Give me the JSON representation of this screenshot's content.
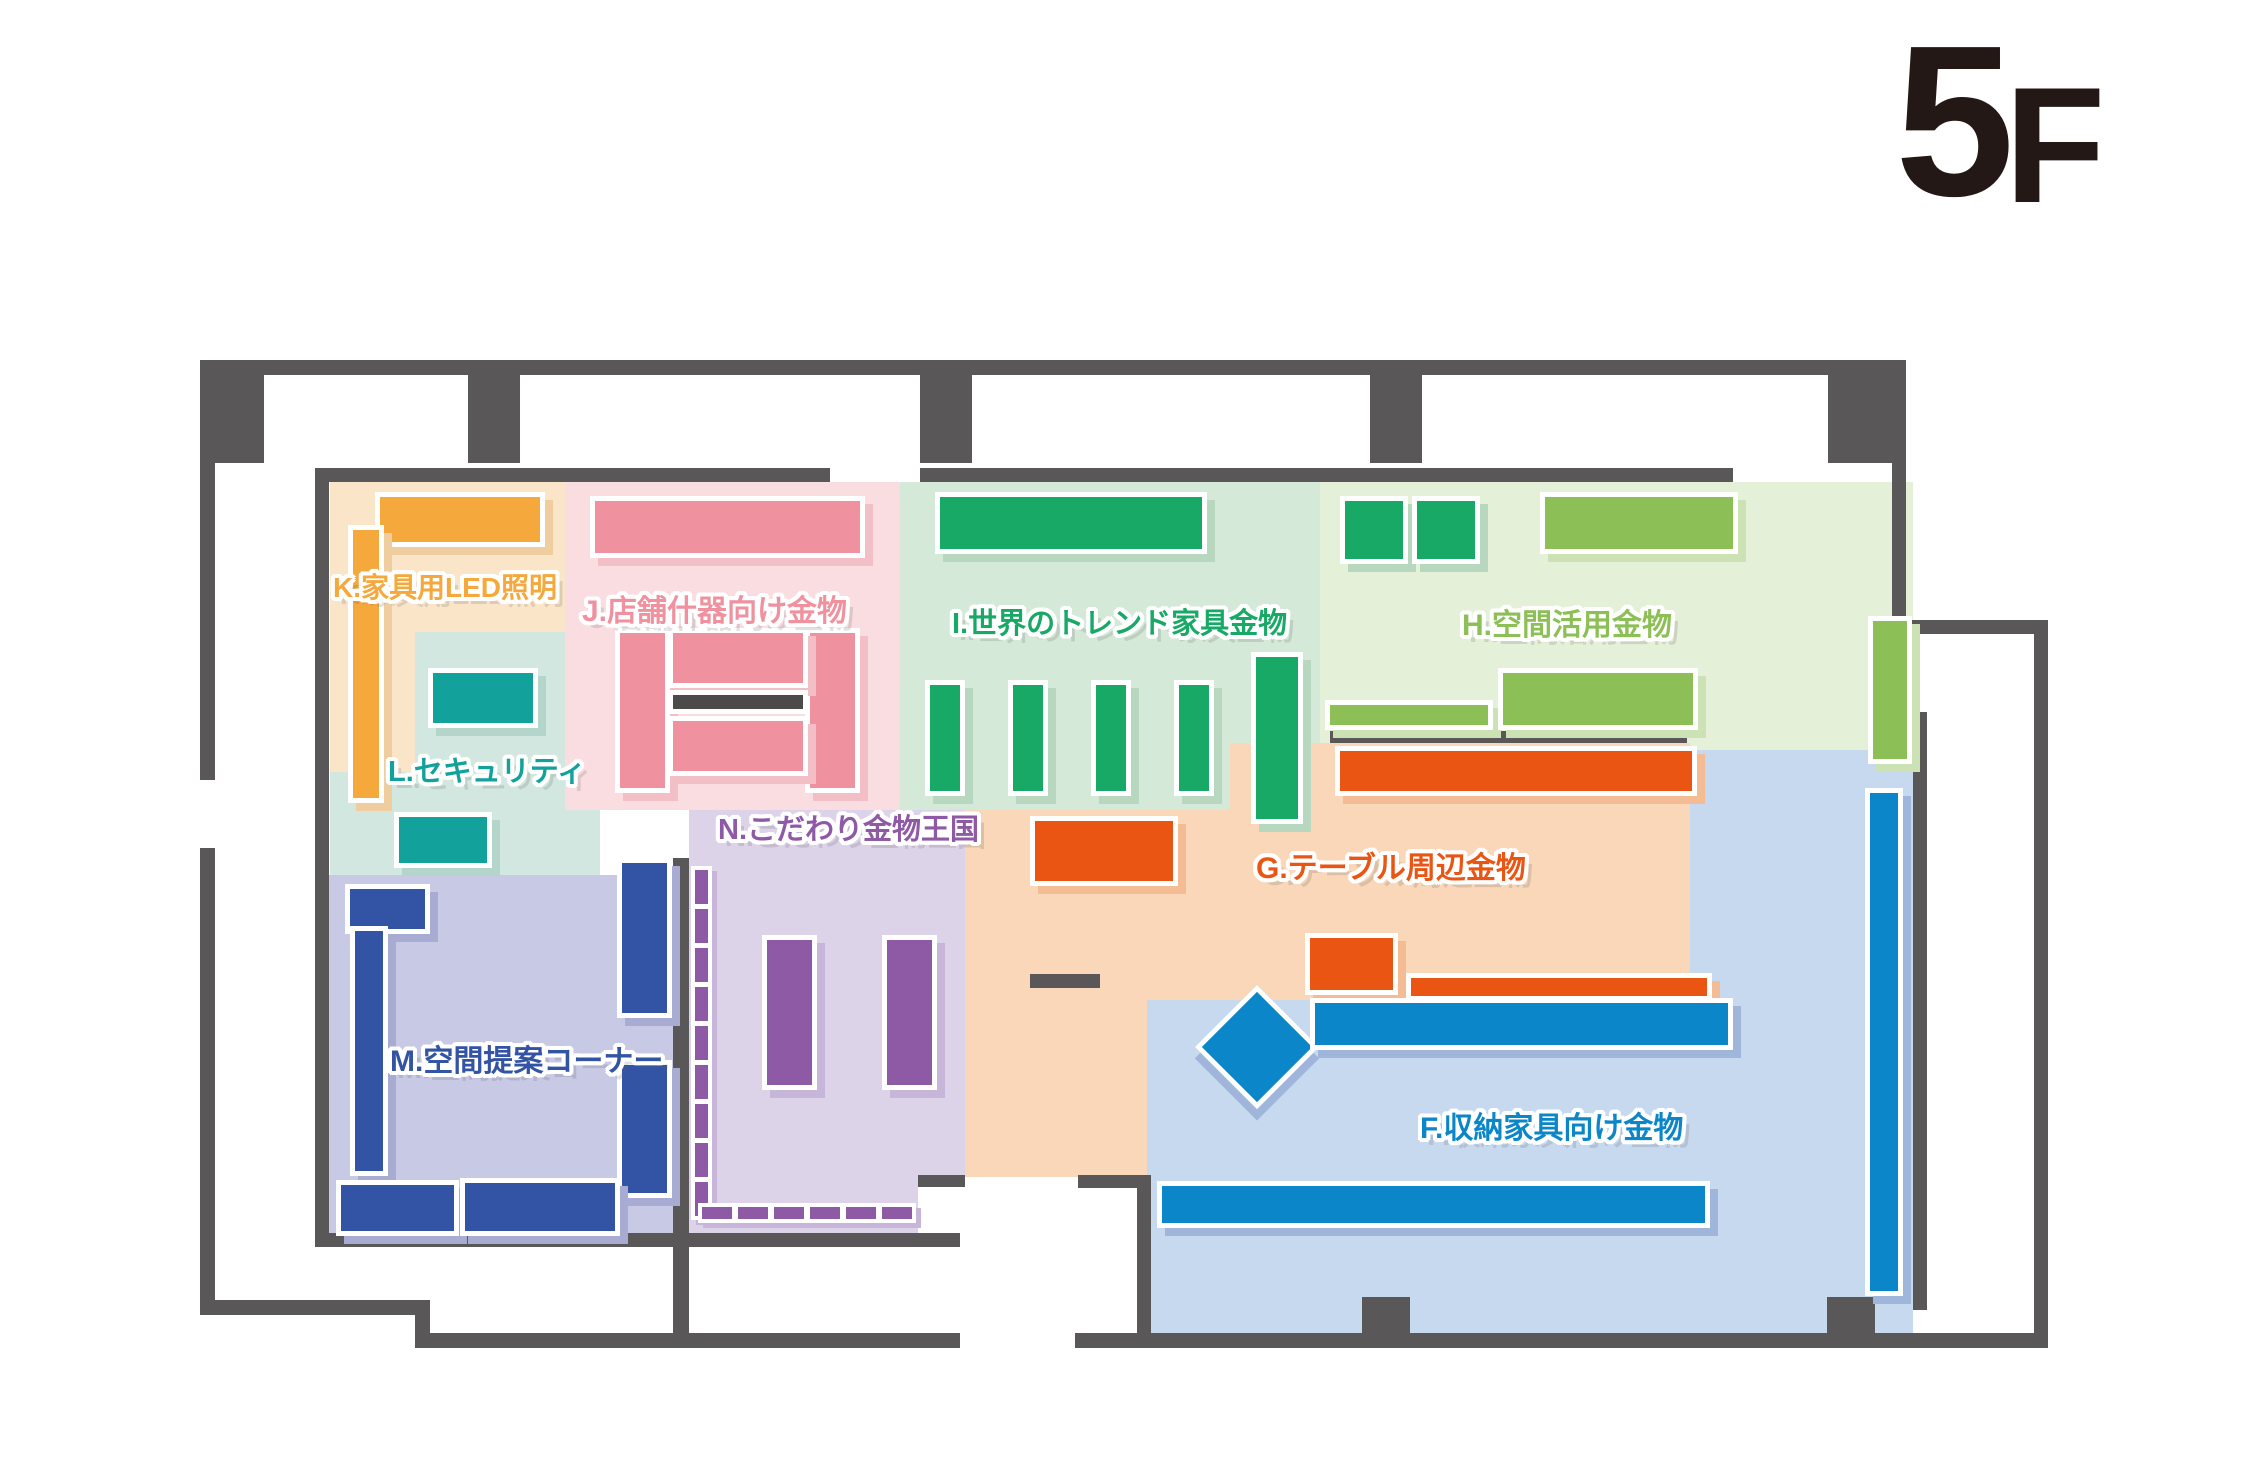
{
  "title": {
    "text": "5F",
    "number": "5",
    "letter": "F",
    "color": "#231815"
  },
  "walls": {
    "color": "#595757"
  },
  "zones": {
    "f": {
      "id": "F",
      "label": "F.収納家具向け金物",
      "accent": "#0b86c8",
      "bg": "#c6d9ef"
    },
    "g": {
      "id": "G",
      "label": "G.テーブル周辺金物",
      "accent": "#ea5514",
      "bg": "#f9d7b8"
    },
    "h": {
      "id": "H",
      "label": "H.空間活用金物",
      "accent": "#8cc057",
      "bg": "#e5f0d8"
    },
    "i": {
      "id": "I",
      "label": "I.世界のトレンド家具金物",
      "accent": "#17a965",
      "bg": "#d5e9d8"
    },
    "j": {
      "id": "J",
      "label": "J.店舗什器向け金物",
      "accent": "#f0919f",
      "bg": "#fadde1"
    },
    "k": {
      "id": "K",
      "label": "K.家具用LED照明",
      "accent": "#f5a93c",
      "bg": "#fbe5c8"
    },
    "l": {
      "id": "L",
      "label": "L.セキュリティ",
      "accent": "#12a29b",
      "bg": "#d2e7df"
    },
    "m": {
      "id": "M",
      "label": "M.空間提案コーナー",
      "accent": "#3353a5",
      "bg": "#c7c9e5"
    },
    "n": {
      "id": "N",
      "label": "N.こだわり金物王国",
      "accent": "#8f5aa5",
      "bg": "#ddd3e9"
    }
  }
}
